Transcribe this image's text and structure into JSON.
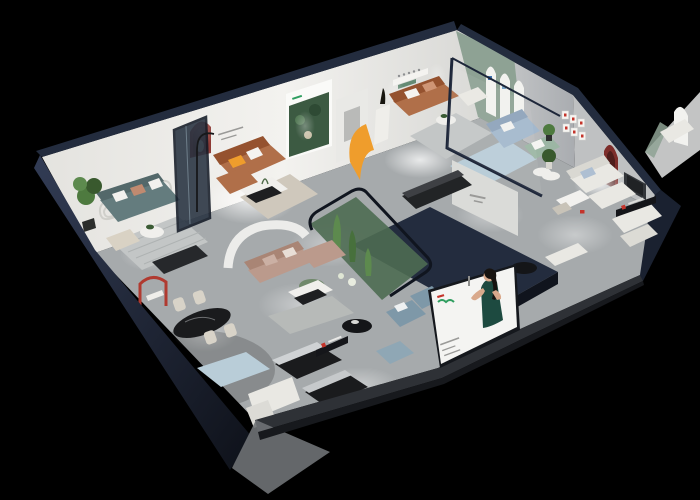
{
  "scene": {
    "kind": "isometric-cutaway-showroom-render",
    "description": "3D cutaway render of a furniture showroom floor plan on black background",
    "counts": {
      "arched_wall_panels": 3,
      "gallery_frames": 6,
      "dining_chairs": 4
    },
    "rooms": [
      {
        "id": "teal-sofa-lounge"
      },
      {
        "id": "caramel-leather-lounge"
      },
      {
        "id": "brown-sofa-arch-room"
      },
      {
        "id": "glass-blue-sofa-room"
      },
      {
        "id": "white-sofa-suite"
      },
      {
        "id": "mauve-sectional-room"
      },
      {
        "id": "dining-area"
      },
      {
        "id": "front-lounge"
      },
      {
        "id": "terrarium-garden"
      }
    ],
    "billboard": {
      "subject": "woman-in-green-dress-advert"
    }
  },
  "palette": {
    "bg": "#000000",
    "navy_dark": "#10141d",
    "navy": "#232c3e",
    "navy_light": "#333e58",
    "wall_light": "#efefec",
    "wall_mid": "#d9d9d6",
    "wall_ne": "#c9cbcc",
    "wall_ne_dark": "#aeb0b3",
    "floor": "#a6aaac",
    "floor_light": "#d9dcdc",
    "slab": "#2e3136",
    "slab_gray": "#6f7276",
    "green_wall": "#8ea294",
    "arch_white": "#f2f2ef",
    "forest": "#3c5a42",
    "poster_white": "#fafaf8",
    "red_niche": "#8e3a35",
    "red_niche_dark": "#6d2622",
    "accent_red": "#c4342b",
    "accent_orange": "#ef9d2c",
    "sofa_teal": "#647c7e",
    "sofa_caramel": "#b06f49",
    "sofa_caramel_dark": "#95522f",
    "sofa_blue": "#a3b8cd",
    "sofa_green": "#9cb6a4",
    "sofa_mauve": "#bb9a8c",
    "sofa_white": "#e9e8e3",
    "sofa_bluegray": "#7e98a8",
    "cream": "#d8d3c8",
    "black_furniture": "#1a1b1d",
    "rug_blue": "#b9cdd8",
    "rug_gray": "#c3c6c6",
    "rug_beige": "#cfc8bc",
    "plant": "#4e7a3f",
    "plant_dark": "#39592e",
    "glass_green": "#4e6b52",
    "billboard_white": "#f4f4f2",
    "dress_green": "#1d4a40",
    "skin": "#d9a98c",
    "hair": "#171310",
    "logo_green": "#2f9e60",
    "text_gray": "#9a9a98"
  }
}
